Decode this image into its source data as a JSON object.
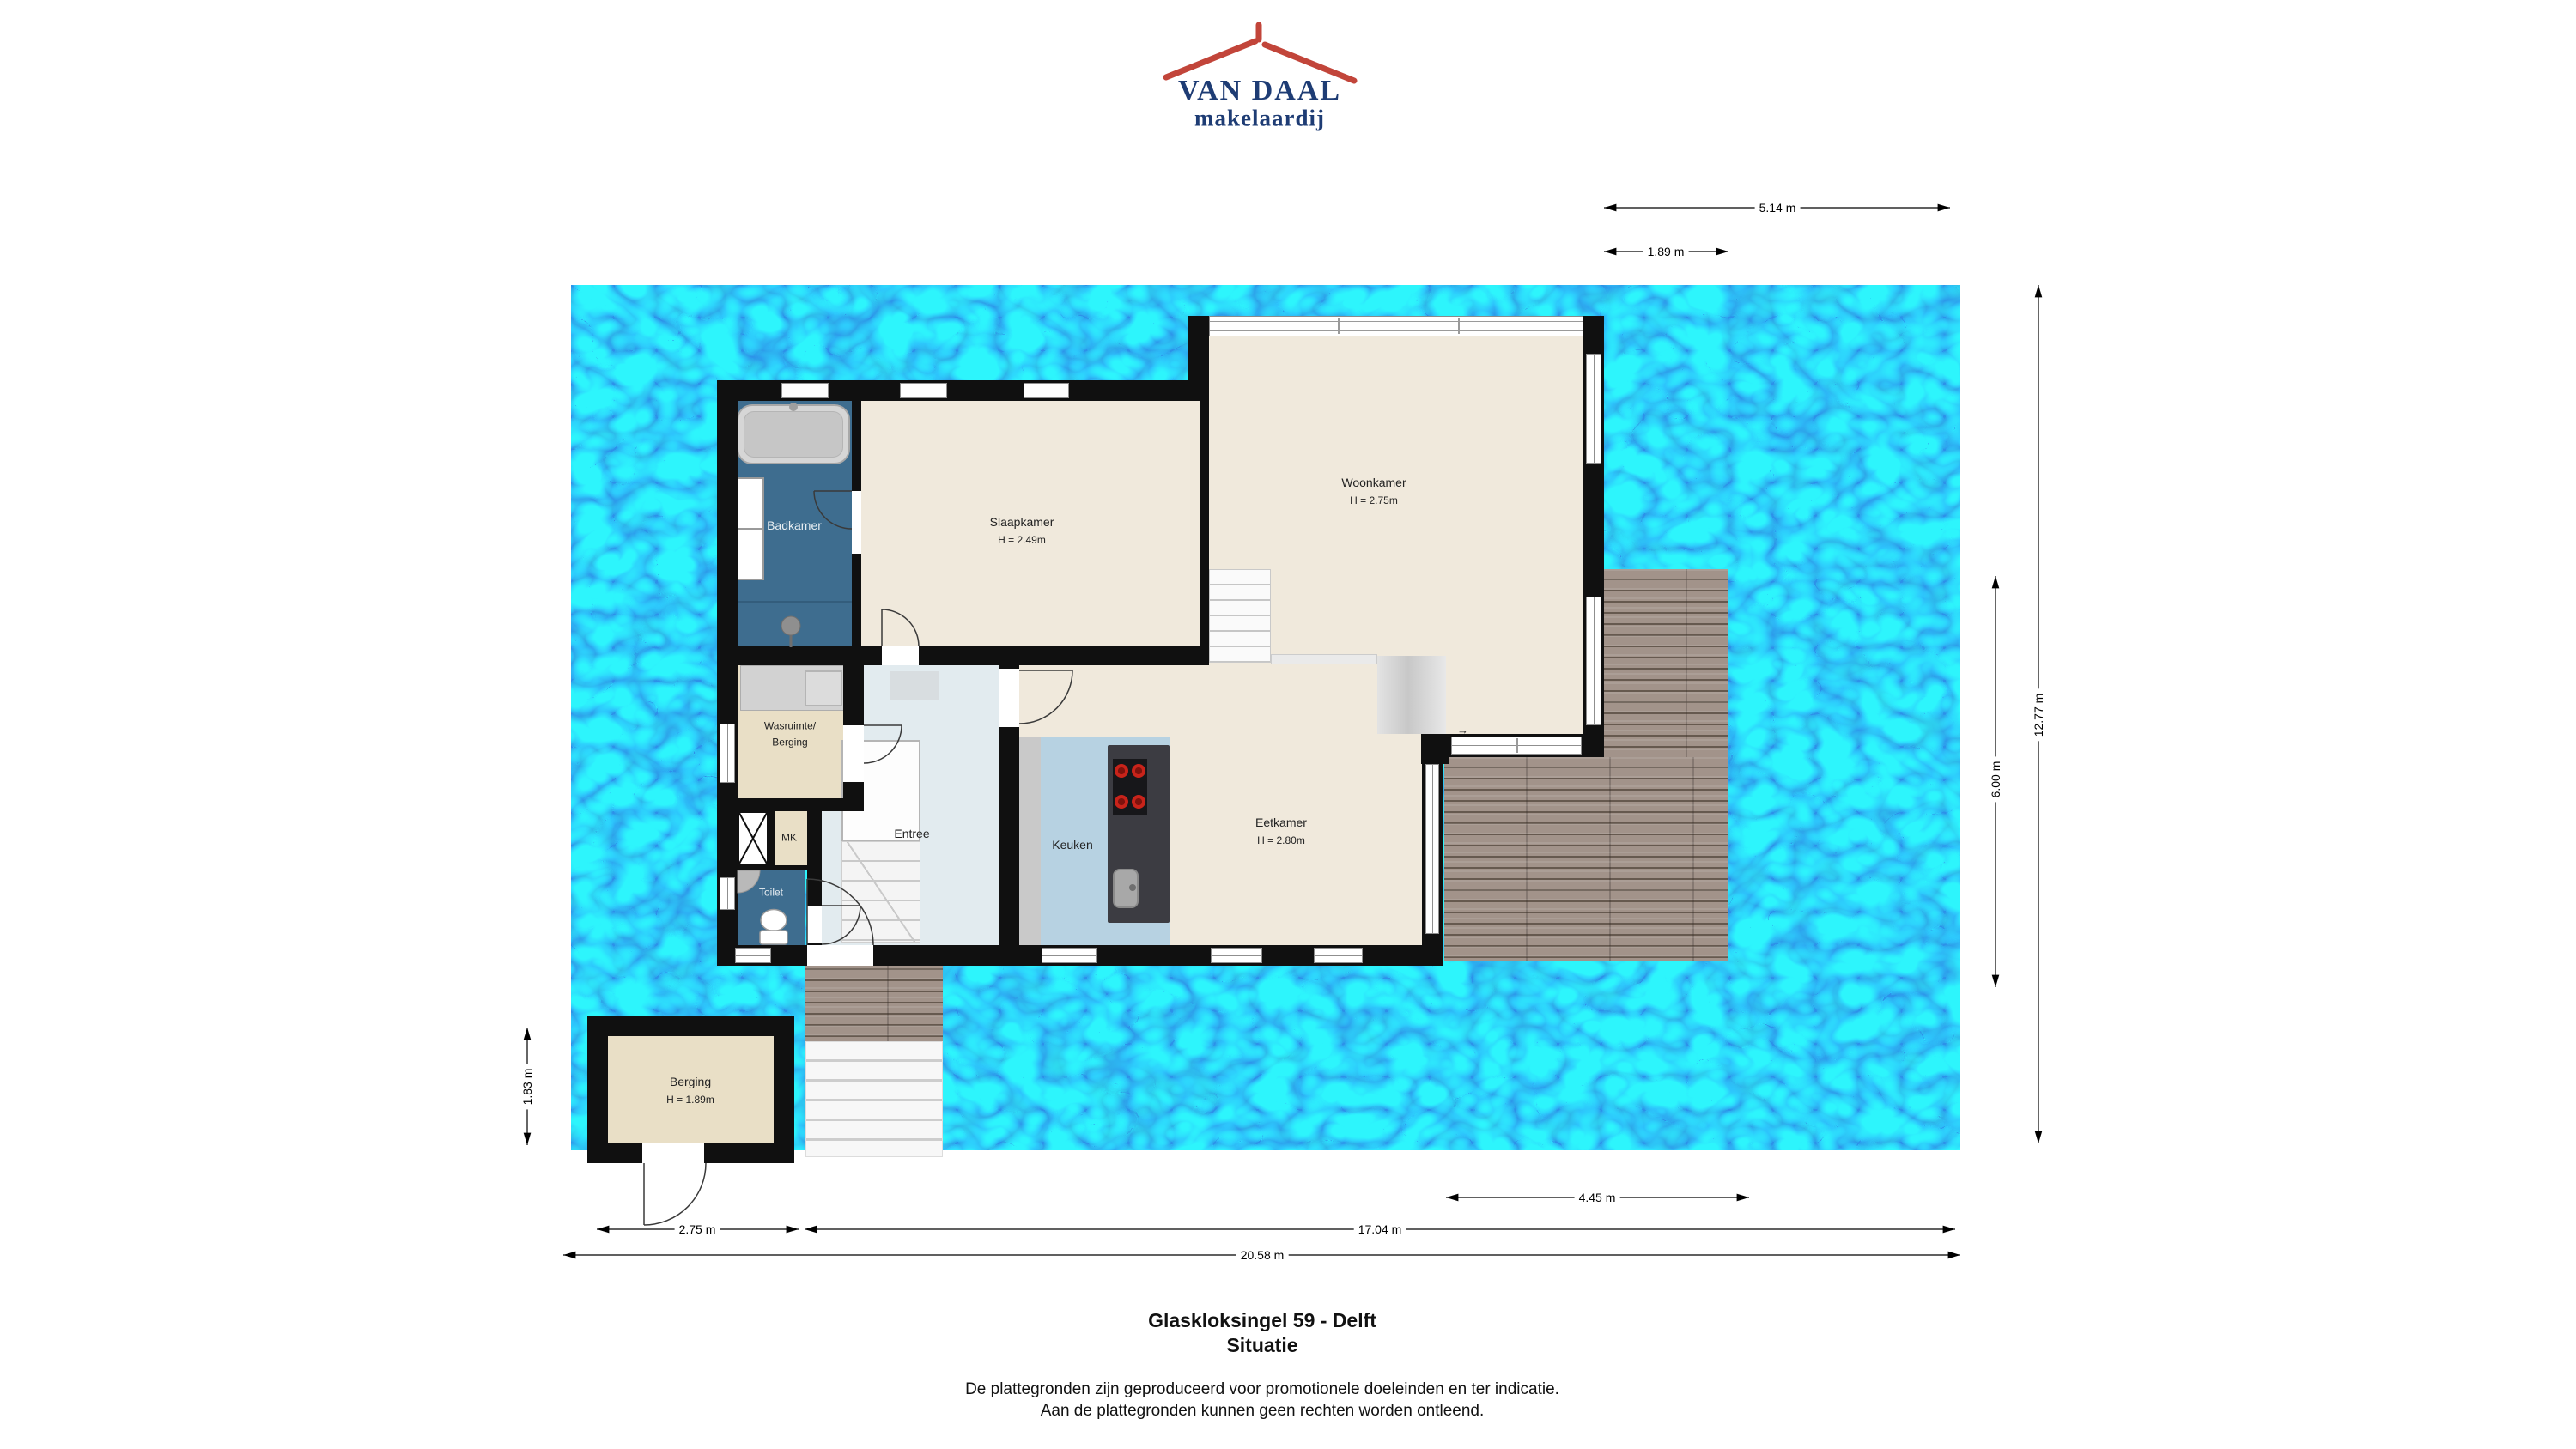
{
  "logo": {
    "name": "VAN DAAL",
    "tagline": "makelaardij",
    "roof_icon": "roof-icon"
  },
  "rooms": {
    "badkamer": {
      "label": "Badkamer"
    },
    "slaapkamer": {
      "label": "Slaapkamer",
      "height": "H = 2.49m"
    },
    "woonkamer": {
      "label": "Woonkamer",
      "height": "H = 2.75m"
    },
    "wasruimte": {
      "label_line1": "Wasruimte/",
      "label_line2": "Berging"
    },
    "mk": {
      "label": "MK"
    },
    "entree": {
      "label": "Entree"
    },
    "toilet": {
      "label": "Toilet"
    },
    "keuken": {
      "label": "Keuken"
    },
    "eetkamer": {
      "label": "Eetkamer",
      "height": "H = 2.80m"
    },
    "berging": {
      "label": "Berging",
      "height": "H = 1.89m"
    }
  },
  "dimensions": {
    "top_outer": "5.14 m",
    "top_inner": "1.89 m",
    "right_outer": "12.77 m",
    "right_inner": "6.00 m",
    "left_berging": "1.83 m",
    "bottom_terrace": "4.45 m",
    "bottom_berging": "2.75 m",
    "bottom_house": "17.04 m",
    "bottom_total": "20.58 m"
  },
  "footer": {
    "address": "Glaskloksingel 59 - Delft",
    "sheet": "Situatie",
    "disclaimer_line1": "De plattegronden zijn geproduceerd voor promotionele doeleinden en ter indicatie.",
    "disclaimer_line2": "Aan de plattegronden kunnen geen rechten worden ontleend."
  },
  "colors": {
    "water": "#17a0e4",
    "wall": "#101010",
    "floor_cream": "#f0e9dc",
    "floor_bathroom": "#3e6d8f",
    "floor_kitchen": "#b7d2e2",
    "floor_storage": "#e9dfc6",
    "floor_hall": "#e2ebef",
    "deck_wood": "#a2938a",
    "logo_blue": "#1e3c74",
    "logo_red": "#c2453a"
  }
}
